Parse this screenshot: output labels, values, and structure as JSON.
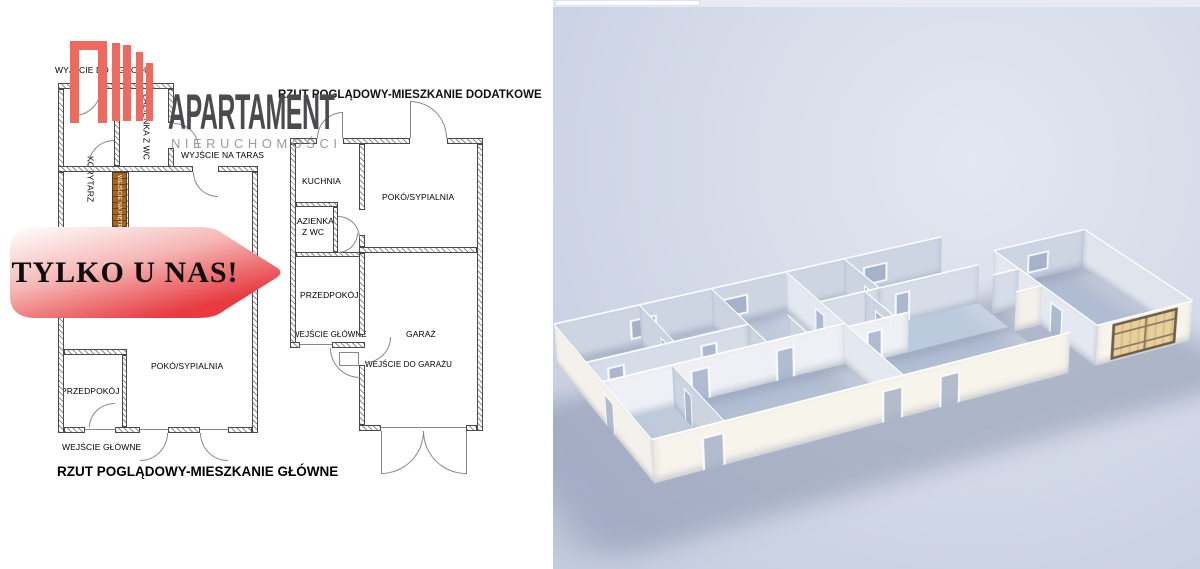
{
  "brand": {
    "name": "APARTAMENT",
    "subtitle": "NIERUCHOMOŚCI",
    "logo_color": "#f1695d"
  },
  "banner": {
    "text": "TYLKO U NAS!",
    "gradient_start": "#ffffff",
    "gradient_end": "#e73b41"
  },
  "plan_additional": {
    "title": "RZUT POGLĄDOWY-MIESZKANIE DODATKOWE",
    "rooms": {
      "kuchnia": "KUCHNIA",
      "pokoj_sypialnia": "POKÓ/SYPIALNIA",
      "lazienka": "ŁAZIENKA Z WC",
      "przedpokoj": "PRZEDPOKÓJ",
      "garaz": "GARAŻ"
    },
    "labels": {
      "wejscie_glowne": "WEJŚCIE GŁÓWNE",
      "wejscie_do_garazu": "WEJŚCIE DO GARAŻU"
    }
  },
  "plan_main": {
    "caption": "RZUT POGLĄDOWY-MIESZKANIE GŁÓWNE",
    "rooms": {
      "lazienka": "ŁAZIENKA Z WC",
      "korytarz": "KORYTARZ",
      "pokoj_sypialnia": "POKÓ/SYPIALNIA",
      "przedpokoj": "PRZEDPOKÓJ"
    },
    "labels": {
      "wyjscie_do_ogrodu": "WYJŚCIE DO OGRODU",
      "wyjscie_na_taras": "WYJŚCIE NA TARAS",
      "wejscie_na_pietro": "WEJŚCIE NA PIĘTRO",
      "wejscie_glowne": "WEJŚCIE GŁÓWNE"
    }
  },
  "render_3d": {
    "colors": {
      "background_top": "#dde1ec",
      "background_bottom": "#c3cbdf",
      "wall_lit": "#f7f4ec",
      "wall_shaded": "#ccd4e2",
      "floor": "#bccadd",
      "garage_door": "#e4c995",
      "stairs": "#d8a023"
    }
  }
}
